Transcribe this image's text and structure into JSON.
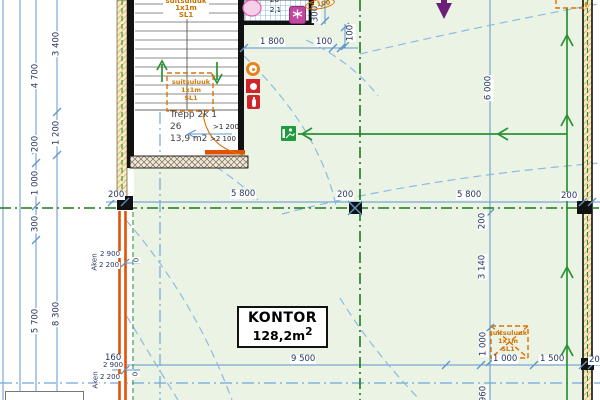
{
  "room": {
    "name": "KONTOR",
    "area": "128,2m",
    "area_sup": "2"
  },
  "stairwell": {
    "title": "Trepp 2k 1",
    "number": "26",
    "area": "13,9 m2",
    "door_clear_width": ">1 200",
    "door_clear_height": ">2 100"
  },
  "smoke_hatch_label": {
    "line1": "suitsuluuk",
    "line2": "1x1m",
    "line3": "SL1"
  },
  "wc_room": {
    "number": "26",
    "area": "2,1"
  },
  "door_height_tag": "2 100",
  "windows": {
    "mid": {
      "label": "Aken",
      "width": "2 900",
      "height": "2 200",
      "sill": "0"
    },
    "bottom": {
      "label": "Aken",
      "width": "2 900",
      "height": "2 200",
      "sill": "0"
    }
  },
  "dims": {
    "left_4700": "4 700",
    "left_3400": "3 400",
    "left_1200": "1 200",
    "left_200": "200",
    "left_1000": "1 000",
    "left_300": "300",
    "left_5700": "5 700",
    "left_8300": "8 300",
    "mid_200_left": "200",
    "mid_5800_left": "5 800",
    "mid_200_center": "200",
    "mid_5800_right": "5 800",
    "mid_200_right": "200",
    "top_1800": "1 800",
    "top_100": "100",
    "top_300": "300",
    "top_100_side": "100",
    "right_6000": "6 000",
    "right_200": "200",
    "right_3140": "3 140",
    "right_1000": "1 000",
    "right_960": "960",
    "bottom_160": "160",
    "bottom_9500": "9 500",
    "bottom_1000": "1 000",
    "bottom_1500": "1 500",
    "bottom_200": "200"
  },
  "colors": {
    "dimension_blue": "#5f97cc",
    "escape_green": "#2a9235",
    "fire_line_green": "#1d7a1d",
    "hatch_orange": "#d2760a",
    "wall_orange": "#e05206",
    "axis_dash_blue": "#8fb9e4",
    "room_green": "#eaf3e4"
  }
}
